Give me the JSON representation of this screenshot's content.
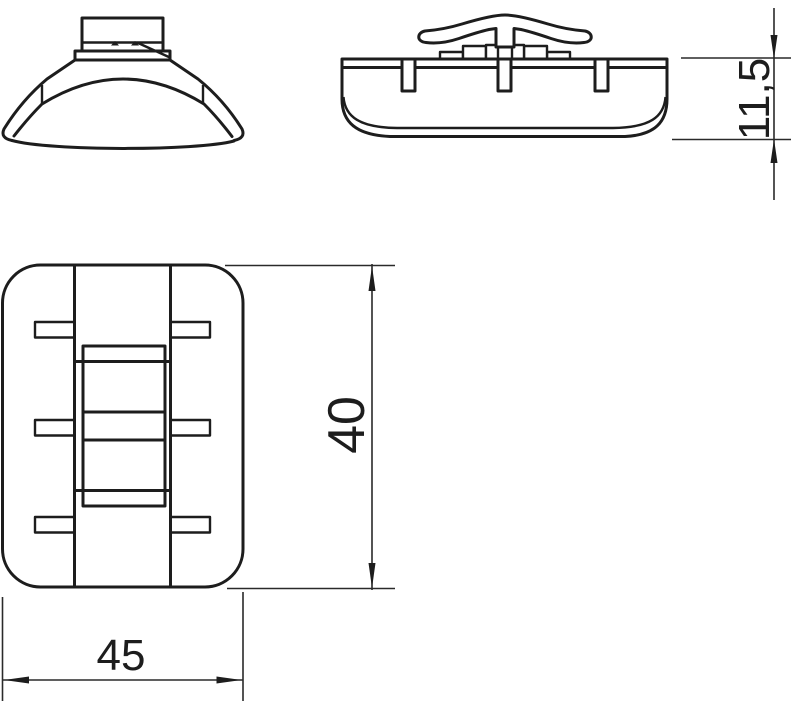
{
  "drawing": {
    "background_color": "#ffffff",
    "line_color": "#1d1d1d",
    "dimensions": {
      "height": "11,5",
      "length": "40",
      "width": "45"
    }
  }
}
